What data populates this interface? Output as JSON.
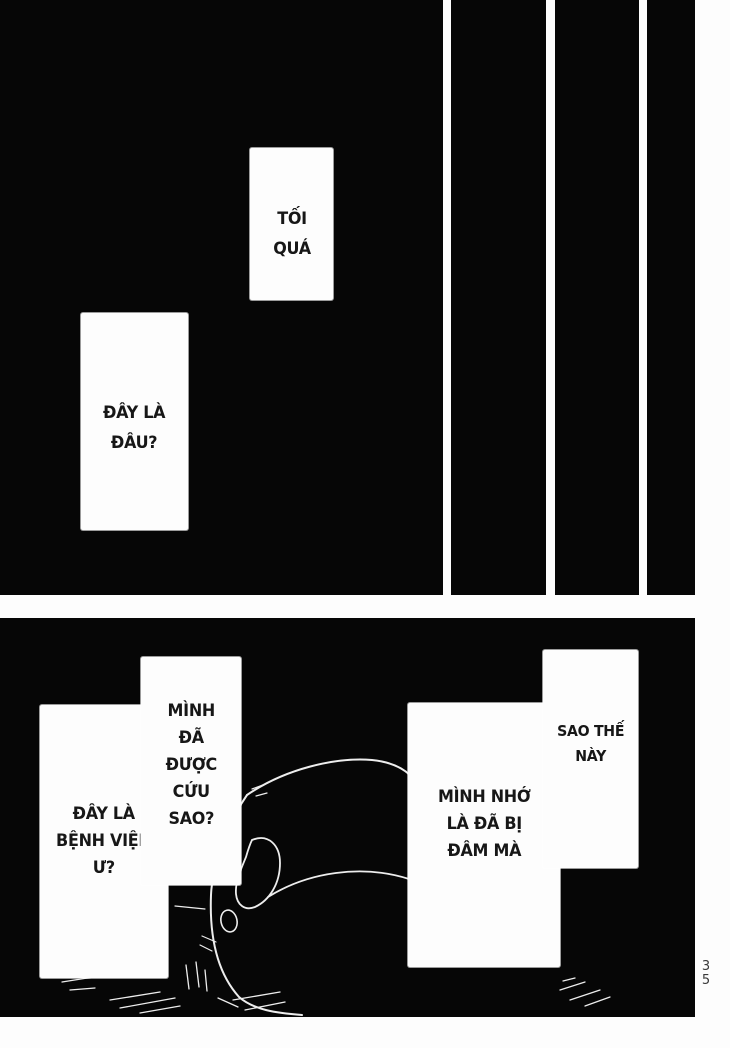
{
  "page": {
    "paper_color": "#fdfdfd",
    "ink_color": "#060606",
    "page_number_vertical": {
      "top_digit": "3",
      "bottom_digit": "5"
    }
  },
  "bubbles": [
    {
      "id": "toi-qua",
      "lines": [
        "TỐI",
        "QUÁ"
      ]
    },
    {
      "id": "day-la-dau",
      "lines": [
        "ĐÂY LÀ",
        "ĐÂU?"
      ]
    },
    {
      "id": "duoc-cuu",
      "lines": [
        "MÌNH",
        "ĐÃ",
        "ĐƯỢC",
        "CỨU",
        "SAO?"
      ]
    },
    {
      "id": "benh-vien",
      "lines": [
        "ĐÂY LÀ",
        "BỆNH VIỆN",
        "Ư?"
      ]
    },
    {
      "id": "bi-dam",
      "lines": [
        "MÌNH NHỚ",
        "LÀ ĐÃ BỊ",
        "ĐÂM MÀ"
      ]
    },
    {
      "id": "sao-the-nay",
      "lines": [
        "SAO THẾ",
        "NÀY"
      ]
    }
  ]
}
